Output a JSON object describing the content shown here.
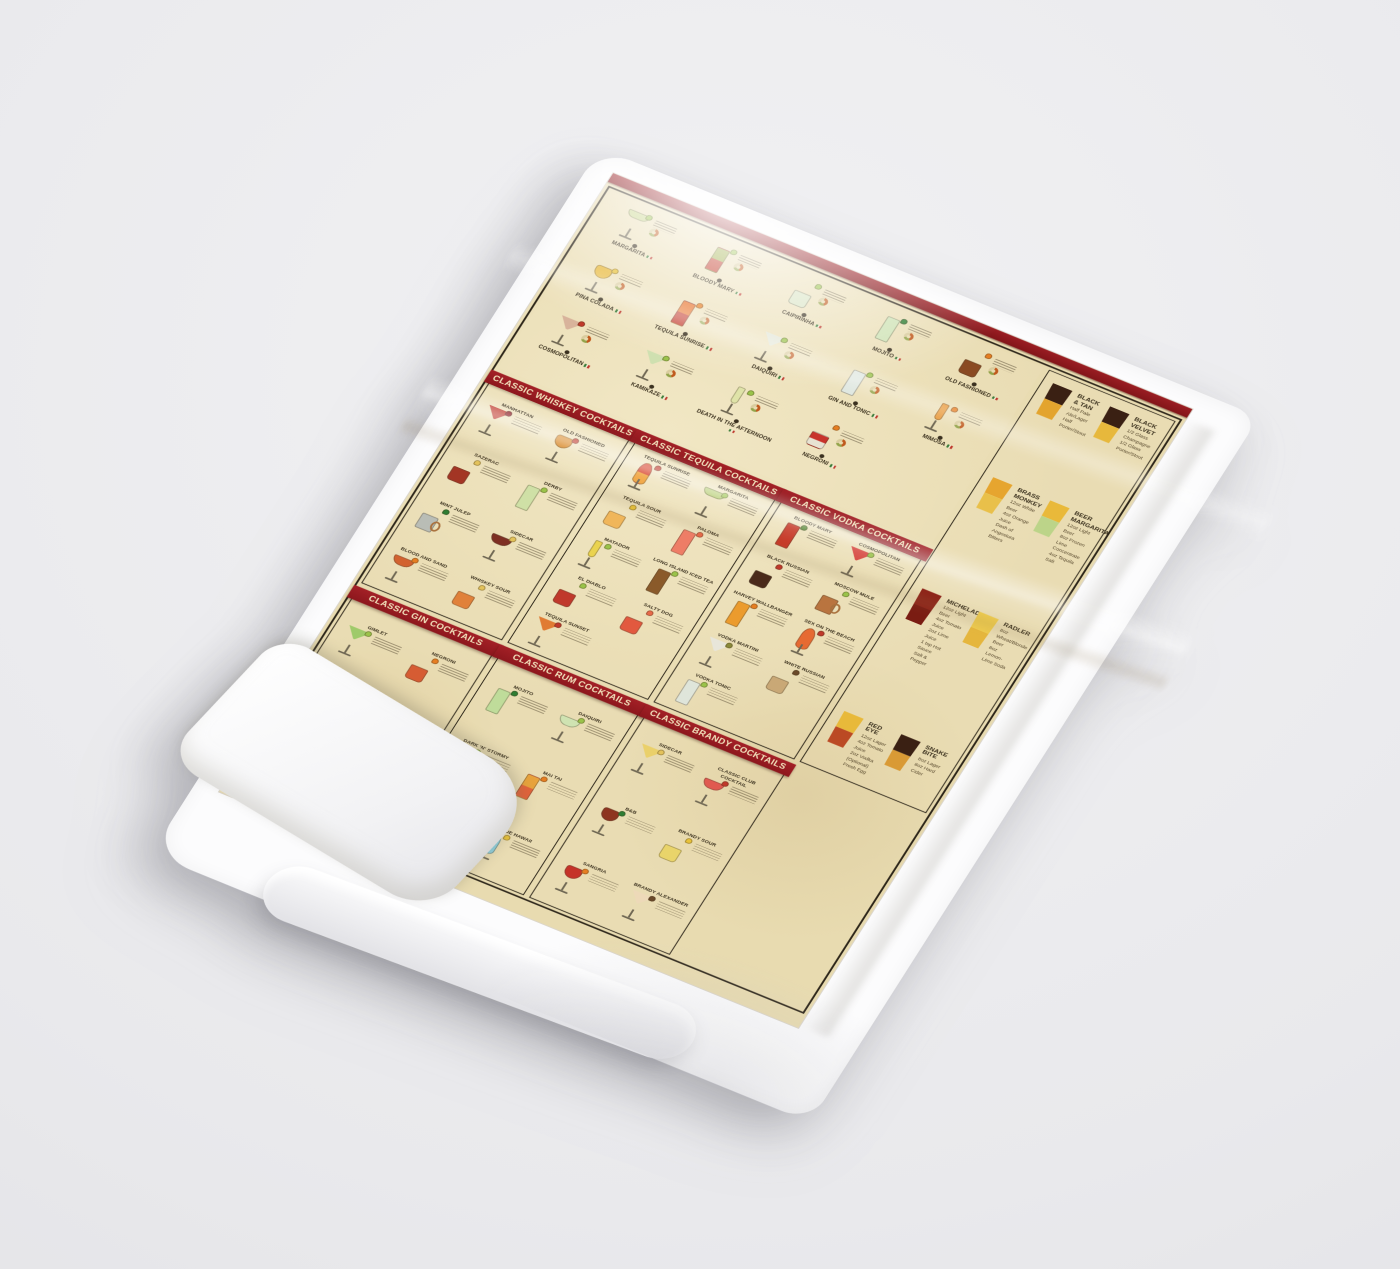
{
  "scene": {
    "description": "White tea towel printed with a vintage classic-cocktails recipe chart, photographed at an angle on a light gray background",
    "background_color": "#e9e9ec",
    "towel_color": "#fcfcfd",
    "paper_color": "#e8dbb0",
    "accent_red": "#9a1d23",
    "frame_color": "#2b2418"
  },
  "famous": {
    "items": [
      {
        "name": "MARGARITA",
        "glass": "margarita",
        "colors": [
          "#c9d68d"
        ],
        "garnish": "#9ac34a"
      },
      {
        "name": "BLOODY MARY",
        "glass": "highball",
        "colors": [
          "#9fae4a",
          "#c23b2a"
        ],
        "garnish": "#9ac34a"
      },
      {
        "name": "CAIPIRINHA",
        "glass": "rocks",
        "colors": [
          "#d9e4c4"
        ],
        "garnish": "#9ac34a"
      },
      {
        "name": "MOJITO",
        "glass": "highball",
        "colors": [
          "#cfe3b6"
        ],
        "garnish": "#2e7d32"
      },
      {
        "name": "OLD FASHIONED",
        "glass": "rocks",
        "colors": [
          "#8a4a22"
        ],
        "garnish": "#e67e22"
      },
      {
        "name": "PINA COLADA",
        "glass": "wine",
        "colors": [
          "#e8b93c"
        ],
        "garnish": "#e8c23a"
      },
      {
        "name": "TEQUILA SUNRISE",
        "glass": "highball",
        "colors": [
          "#e8742c",
          "#c2392b"
        ],
        "garnish": "#e67e22"
      },
      {
        "name": "DAIQUIRI",
        "glass": "martini",
        "colors": [
          "#e4e7d8"
        ],
        "garnish": "#9ac34a"
      },
      {
        "name": "GIN AND TONIC",
        "glass": "highball",
        "colors": [
          "#dfe7e0"
        ],
        "garnish": "#9ac34a"
      },
      {
        "name": "MIMOSA",
        "glass": "flute",
        "colors": [
          "#e89a3c"
        ],
        "garnish": "#e67e22"
      },
      {
        "name": "COSMOPOLITAN",
        "glass": "martini",
        "colors": [
          "#d8b39b"
        ],
        "garnish": "#c0392b"
      },
      {
        "name": "KAMIKAZE",
        "glass": "martini",
        "colors": [
          "#cfe0b0"
        ],
        "garnish": "#9ac34a"
      },
      {
        "name": "DEATH IN THE AFTERNOON",
        "glass": "flute",
        "colors": [
          "#dfe3a8"
        ],
        "garnish": "#9ac34a"
      },
      {
        "name": "NEGRONI",
        "glass": "rocks",
        "colors": [
          "#c8332b",
          "#e7e2d2"
        ],
        "garnish": "#e67e22"
      }
    ]
  },
  "beer": {
    "items": [
      {
        "name": "BLACK & TAN",
        "colors": [
          "#3a2013",
          "#e3a42e"
        ],
        "recipe": [
          "Half Pale Ale/Lager",
          "Half Porter/Stout"
        ]
      },
      {
        "name": "BLACK VELVET",
        "colors": [
          "#3a2013",
          "#e7b83c"
        ],
        "recipe": [
          "1/2 Glass Champagne",
          "1/2 Glass Porter/Stout"
        ]
      },
      {
        "name": "BRASS MONKEY",
        "colors": [
          "#e6a52f",
          "#e9c04a"
        ],
        "recipe": [
          "12oz White Beer",
          "4oz Orange Juice",
          "Dash of Angostura Bitters"
        ]
      },
      {
        "name": "BEER MARGARITA",
        "colors": [
          "#e9b93a",
          "#bcd489"
        ],
        "recipe": [
          "12oz Light Beer",
          "8oz Frozen Lime Concentrate",
          "4oz Tequila",
          "Salt"
        ]
      },
      {
        "name": "MICHELADA",
        "colors": [
          "#8e2318",
          "#7a1c12"
        ],
        "recipe": [
          "12oz Light Beer",
          "4oz Tomato Juice",
          "2oz Lime Juice",
          "1 tsp Hot Sauce",
          "Salt & Pepper"
        ]
      },
      {
        "name": "RADLER",
        "colors": [
          "#eecb4e",
          "#e5b63d"
        ],
        "recipe": [
          "8oz Wheat/Blonde Beer",
          "8oz Lemon-Lime Soda"
        ]
      },
      {
        "name": "RED EYE",
        "colors": [
          "#e8b93a",
          "#bb4a24"
        ],
        "recipe": [
          "12oz Lager",
          "4oz Tomato Juice",
          "2oz Vodka (Optional)",
          "Fresh Egg"
        ]
      },
      {
        "name": "SNAKE BITE",
        "colors": [
          "#3a2013",
          "#d99a35"
        ],
        "recipe": [
          "8oz Lager",
          "8oz Hard Cider"
        ]
      }
    ]
  },
  "sections": [
    {
      "id": "whiskey",
      "title": "CLASSIC WHISKEY COCKTAILS",
      "items": [
        {
          "name": "MANHATTAN",
          "glass": "martini",
          "colors": [
            "#bf3a2e"
          ],
          "garnish": "#8e1d25"
        },
        {
          "name": "OLD FASHIONED",
          "glass": "wine",
          "colors": [
            "#d98a2b"
          ],
          "garnish": "#c0392b"
        },
        {
          "name": "SAZERAC",
          "glass": "rocks",
          "colors": [
            "#a33524"
          ],
          "garnish": "#e3c25b"
        },
        {
          "name": "DERBY",
          "glass": "highball",
          "colors": [
            "#cfe0a6"
          ],
          "garnish": "#9ac34a"
        },
        {
          "name": "MINT JULEP",
          "glass": "mug",
          "colors": [
            "#b9bdb6"
          ],
          "garnish": "#2e7d32"
        },
        {
          "name": "SIDECAR",
          "glass": "coupe",
          "colors": [
            "#7e2f23"
          ],
          "garnish": "#e3c25b"
        },
        {
          "name": "BLOOD AND SAND",
          "glass": "coupe",
          "colors": [
            "#d2622f"
          ],
          "garnish": "#e67e22"
        },
        {
          "name": "WHISKEY SOUR",
          "glass": "rocks",
          "colors": [
            "#e0813a"
          ],
          "garnish": "#e3c25b"
        }
      ]
    },
    {
      "id": "tequila",
      "title": "CLASSIC TEQUILA COCKTAILS",
      "items": [
        {
          "name": "TEQUILA SUNRISE",
          "glass": "hurricane",
          "colors": [
            "#d8432c",
            "#f0a23a"
          ],
          "garnish": "#c0392b"
        },
        {
          "name": "MARGARITA",
          "glass": "margarita",
          "colors": [
            "#b9cf79"
          ],
          "garnish": "#9ac34a"
        },
        {
          "name": "TEQUILA SOUR",
          "glass": "rocks",
          "colors": [
            "#f0b65a"
          ],
          "garnish": "#e8c23a"
        },
        {
          "name": "PALOMA",
          "glass": "highball",
          "colors": [
            "#ee7d66"
          ],
          "garnish": "#e86a4a"
        },
        {
          "name": "MATADOR",
          "glass": "flute",
          "colors": [
            "#ead34f"
          ],
          "garnish": "#9ac34a"
        },
        {
          "name": "LONG ISLAND ICED TEA",
          "glass": "highball",
          "colors": [
            "#8a5a2a"
          ],
          "garnish": "#9ac34a"
        },
        {
          "name": "EL DIABLO",
          "glass": "rocks",
          "colors": [
            "#c0392b"
          ],
          "garnish": "#9ac34a"
        },
        {
          "name": "SALTY DOG",
          "glass": "rocks",
          "colors": [
            "#e2593f"
          ],
          "garnish": "#e86a4a"
        },
        {
          "name": "TEQUILA SUNSET",
          "glass": "martini",
          "colors": [
            "#e07b33"
          ],
          "garnish": "#c0392b"
        }
      ]
    },
    {
      "id": "vodka",
      "title": "CLASSIC VODKA COCKTAILS",
      "items": [
        {
          "name": "BLOODY MARY",
          "glass": "highball",
          "colors": [
            "#c63a28"
          ],
          "garnish": "#5c8a3a"
        },
        {
          "name": "COSMOPOLITAN",
          "glass": "martini",
          "colors": [
            "#d6473f"
          ],
          "garnish": "#9ac34a"
        },
        {
          "name": "BLACK RUSSIAN",
          "glass": "rocks",
          "colors": [
            "#4a2a1a"
          ],
          "garnish": "#c0392b"
        },
        {
          "name": "MOSCOW MULE",
          "glass": "mug",
          "colors": [
            "#b9743f"
          ],
          "garnish": "#9ac34a"
        },
        {
          "name": "HARVEY WALLBANGER",
          "glass": "highball",
          "colors": [
            "#eb9b2d"
          ],
          "garnish": "#e67e22"
        },
        {
          "name": "SEX ON THE BEACH",
          "glass": "hurricane",
          "colors": [
            "#e66a32"
          ],
          "garnish": "#c0392b"
        },
        {
          "name": "VODKA MARTINI",
          "glass": "martini",
          "colors": [
            "#e8e6da"
          ],
          "garnish": "#8a8a3a"
        },
        {
          "name": "WHITE RUSSIAN",
          "glass": "rocks",
          "colors": [
            "#c9a876"
          ],
          "garnish": "#6b4a2a"
        },
        {
          "name": "VODKA TONIC",
          "glass": "highball",
          "colors": [
            "#dfe5da"
          ],
          "garnish": "#9ac34a"
        }
      ]
    },
    {
      "id": "gin",
      "title": "CLASSIC GIN COCKTAILS",
      "items": [
        {
          "name": "GIMLET",
          "glass": "martini",
          "colors": [
            "#9fca6a"
          ],
          "garnish": "#9ac34a"
        },
        {
          "name": "NEGRONI",
          "glass": "rocks",
          "colors": [
            "#d65c33"
          ],
          "garnish": "#e67e22"
        },
        {
          "name": "FRENCH 75",
          "glass": "flute",
          "colors": [
            "#efe3c0"
          ],
          "garnish": "#e3c25b"
        },
        {
          "name": "AVIATION",
          "glass": "martini",
          "colors": [
            "#d8b7c9"
          ],
          "garnish": "#c0392b"
        },
        {
          "name": "VESPER",
          "glass": "martini",
          "colors": [
            "#e9e4cf"
          ],
          "garnish": "#8a8a3a"
        },
        {
          "name": "GIN AND TONIC",
          "glass": "highball",
          "colors": [
            "#bfe0df"
          ],
          "garnish": "#9ac34a"
        }
      ]
    },
    {
      "id": "rum",
      "title": "CLASSIC RUM COCKTAILS",
      "items": [
        {
          "name": "MOJITO",
          "glass": "highball",
          "colors": [
            "#bfdc9a"
          ],
          "garnish": "#2e7d32"
        },
        {
          "name": "DAIQUIRI",
          "glass": "coupe",
          "colors": [
            "#cfe3b2"
          ],
          "garnish": "#9ac34a"
        },
        {
          "name": "DARK 'N' STORMY",
          "glass": "rocks",
          "colors": [
            "#5a2f1b"
          ],
          "garnish": "#9ac34a"
        },
        {
          "name": "MAI TAI",
          "glass": "highball",
          "colors": [
            "#e8a33c",
            "#e2633a"
          ],
          "garnish": "#e67e22"
        },
        {
          "name": "PINA COLADA",
          "glass": "hurricane",
          "colors": [
            "#efe2bb"
          ],
          "garnish": "#c0392b"
        },
        {
          "name": "BLUE HAWAII",
          "glass": "hurricane",
          "colors": [
            "#8fd0dd"
          ],
          "garnish": "#e8c23a"
        }
      ]
    },
    {
      "id": "brandy",
      "title": "CLASSIC BRANDY COCKTAILS",
      "items": [
        {
          "name": "SIDECAR",
          "glass": "martini",
          "colors": [
            "#ead06a"
          ],
          "garnish": "#e3c25b"
        },
        {
          "name": "CLASSIC CLUB COCKTAIL",
          "glass": "coupe",
          "colors": [
            "#e05a50"
          ],
          "garnish": "#c0392b"
        },
        {
          "name": "B&B",
          "glass": "wine",
          "colors": [
            "#8e3420"
          ],
          "garnish": "#2e7d32"
        },
        {
          "name": "BRANDY SOUR",
          "glass": "rocks",
          "colors": [
            "#e9d46a"
          ],
          "garnish": "#e8c23a"
        },
        {
          "name": "SANGRIA",
          "glass": "wine",
          "colors": [
            "#c53228"
          ],
          "garnish": "#e67e22"
        },
        {
          "name": "BRANDY ALEXANDER",
          "glass": "martini",
          "colors": [
            "#edd9b8"
          ],
          "garnish": "#6b4a2a"
        }
      ]
    }
  ]
}
